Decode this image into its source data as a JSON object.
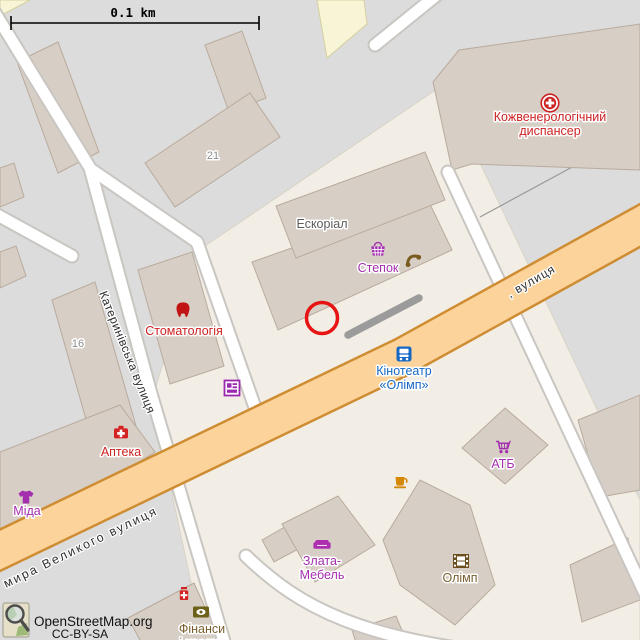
{
  "map": {
    "scale_bar": {
      "label": "0.1 km"
    },
    "attribution": {
      "site": "OpenStreetMap.org",
      "license": "CC-BY-SA"
    },
    "streets": {
      "katerynivska": "Катеринівська вулиця",
      "velykoho": "мира Великого вулиця",
      "right_partial": ", вулиця"
    },
    "house_numbers": {
      "n16": "16",
      "n21": "21"
    },
    "pois": {
      "dispanser": {
        "line1": "Кожвенерологічний",
        "line2": "диспансер"
      },
      "eskorial": {
        "label": "Ескоріал"
      },
      "stepok": {
        "label": "Степок"
      },
      "stomatologia": {
        "label": "Стоматологія"
      },
      "apteka": {
        "label": "Аптека"
      },
      "mida": {
        "label": "Міда"
      },
      "kinoteatr": {
        "line1": "Кінотеатр",
        "line2": "«Олімп»"
      },
      "atb": {
        "label": "АТБ"
      },
      "zlata": {
        "line1": "Злата-",
        "line2": "Мебель"
      },
      "olimp": {
        "label": "Олімп"
      },
      "finansy": {
        "line1": "Фінанси",
        "line2": "і кредит"
      }
    },
    "colors": {
      "background": "#dcdcdc",
      "pedestrian_area": "#f2eee5",
      "building_fill": "#d7cec6",
      "building_stroke": "#b9ab9c",
      "yellow_building": "#f8f4d6",
      "road_fill": "#ffffff",
      "road_casing": "#c9c6c2",
      "main_road_fill": "#fbd39b",
      "main_road_casing": "#cf8d33",
      "poi_red": "#cc2222",
      "poi_purple": "#a32eae",
      "poi_blue": "#1668c5",
      "poi_brown": "#7a5f2e",
      "poi_orange": "#d48806",
      "label_gray": "#5c5c5c",
      "housenumber_gray": "#8d8d8d",
      "highlight_red": "#e81313",
      "highlight_gray": "#9b9b9b"
    }
  }
}
